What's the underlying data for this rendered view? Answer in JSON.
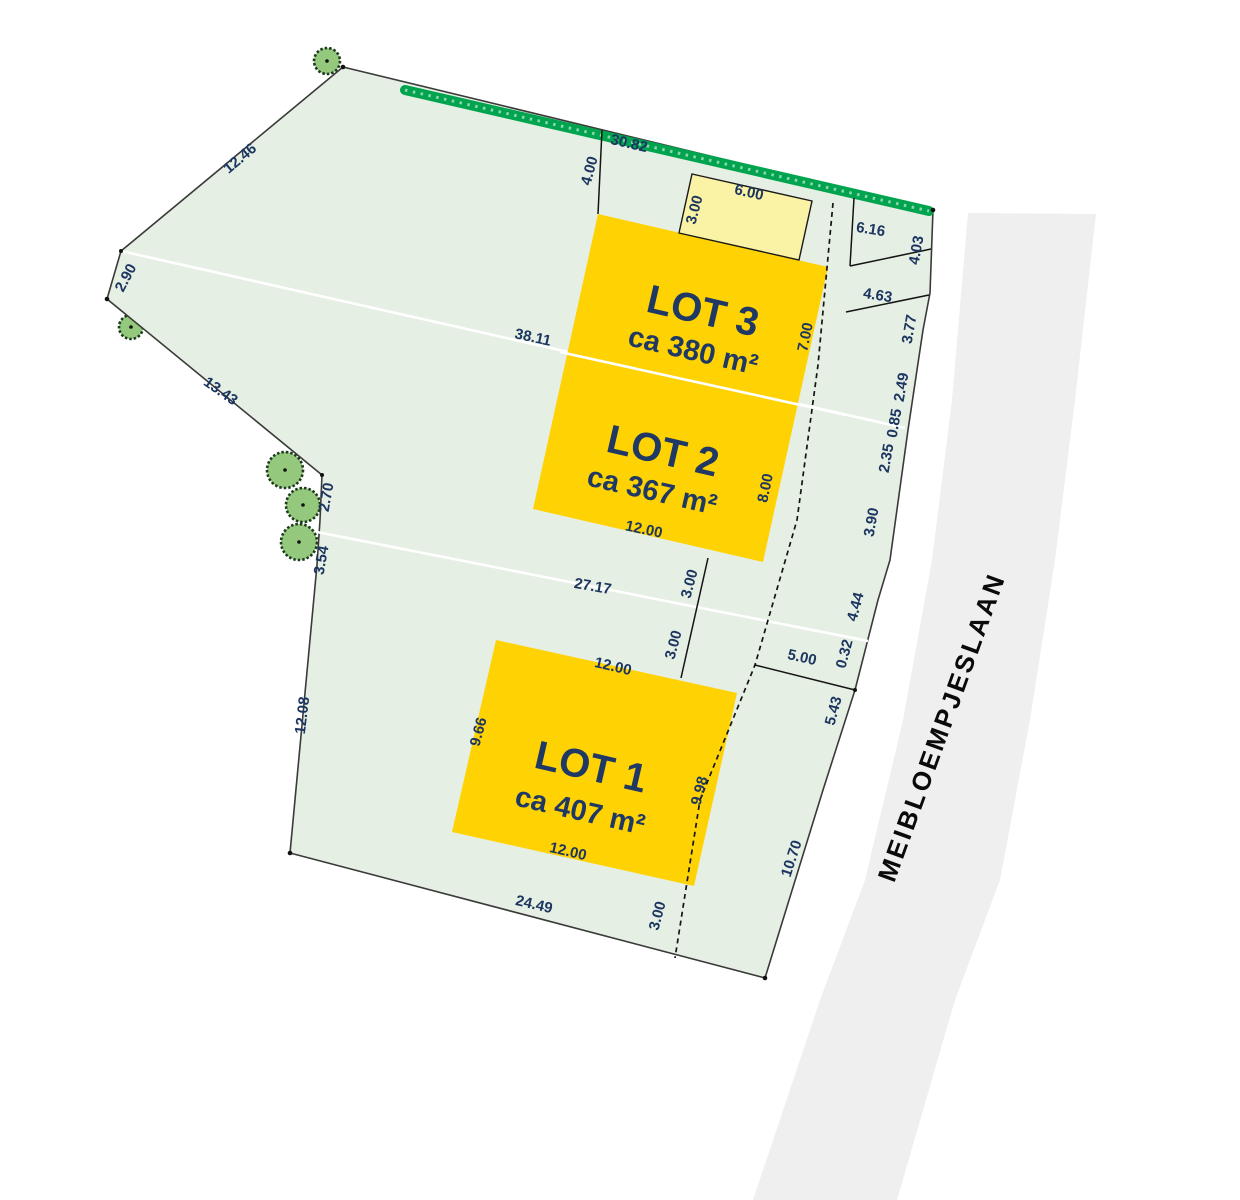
{
  "plan": {
    "street_name": "MEIBLOEMPJESLAAN",
    "lots": [
      {
        "name": "LOT 1",
        "area": "ca 407 m²"
      },
      {
        "name": "LOT 2",
        "area": "ca 367 m²"
      },
      {
        "name": "LOT 3",
        "area": "ca 380 m²"
      }
    ],
    "dims": [
      "12.46",
      "2.90",
      "13.43",
      "38.11",
      "30.82",
      "4.00",
      "3.00",
      "6.00",
      "6.16",
      "4.03",
      "4.63",
      "3.77",
      "2.49",
      "0.85",
      "2.35",
      "3.90",
      "4.44",
      "0.32",
      "5.00",
      "5.43",
      "10.70",
      "7.00",
      "8.00",
      "12.00",
      "27.17",
      "3.00",
      "3.00",
      "12.00",
      "9.66",
      "9.98",
      "12.00",
      "24.49",
      "3.00",
      "12.08",
      "2.70",
      "3.54"
    ]
  },
  "colors": {
    "lot_fill": "#FFD203",
    "parcel_fill": "#E6EFE3",
    "shed_fill": "#FAF3A6",
    "hedge_green": "#00A44F",
    "tree_fill": "#93C87D",
    "road_fill": "#EFEFEF",
    "label_navy": "#1F3864",
    "dim_navy": "#1C3661",
    "street_black": "#0A0A0A"
  }
}
